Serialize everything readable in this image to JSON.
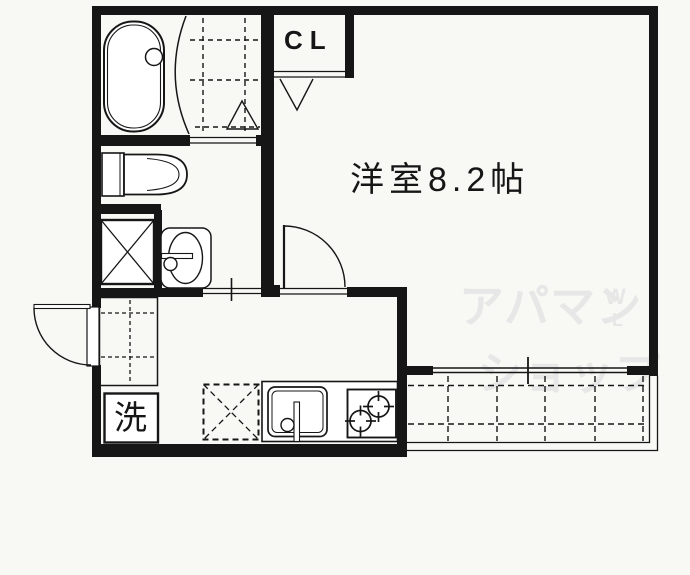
{
  "colors": {
    "background": "#f8f8f4",
    "line": "#161616",
    "watermark": "#e7e7e7"
  },
  "plan": {
    "room_label": "洋室8.2帖",
    "closet_label": "CL",
    "laundry_label": "洗"
  },
  "watermark": {
    "brand_line1": "アパマン",
    "brand_line2": "ショップ",
    "mark_top": "W",
    "mark_bottom": "L"
  }
}
